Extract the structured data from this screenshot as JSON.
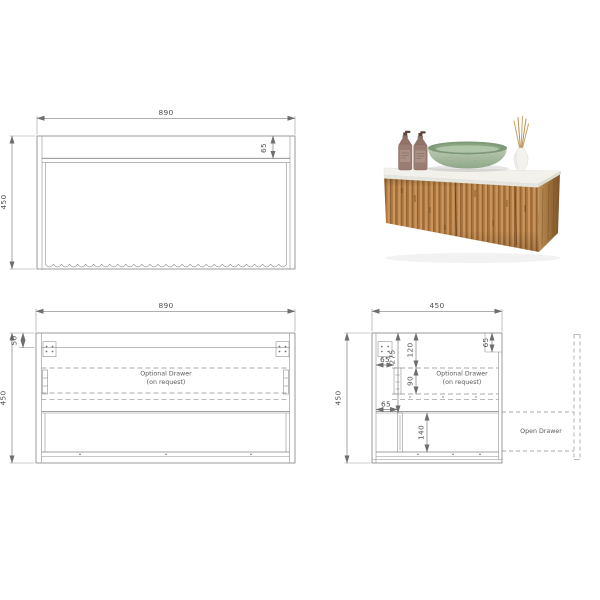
{
  "views": {
    "front": {
      "width_label": "890",
      "height_label": "450",
      "top_rail_label": "65"
    },
    "carcass": {
      "width_label": "890",
      "height_label": "450",
      "top_panel_label": "50",
      "note_line1": "Optional Drawer",
      "note_line2": "(on request)"
    },
    "side": {
      "depth_label": "450",
      "height_label": "450",
      "front_rail_label": "65",
      "drawer_zone_label": "275",
      "top_gap_label": "120",
      "optional_drawer_height_label": "90",
      "slide_setback_top_label": "65",
      "slide_setback_bottom_label": "65",
      "bottom_drawer_height_label": "140",
      "note_line1": "Optional Drawer",
      "note_line2": "(on request)",
      "open_drawer_label": "Open Drawer"
    }
  },
  "photo": {
    "colors": {
      "timber": "#b5824a",
      "timber_dark": "#8a5a2c",
      "countertop": "#f2f1ec",
      "basin_green": "#9db695",
      "bottle_mauve": "#9a7c72",
      "reed_tan": "#c9a266"
    }
  }
}
